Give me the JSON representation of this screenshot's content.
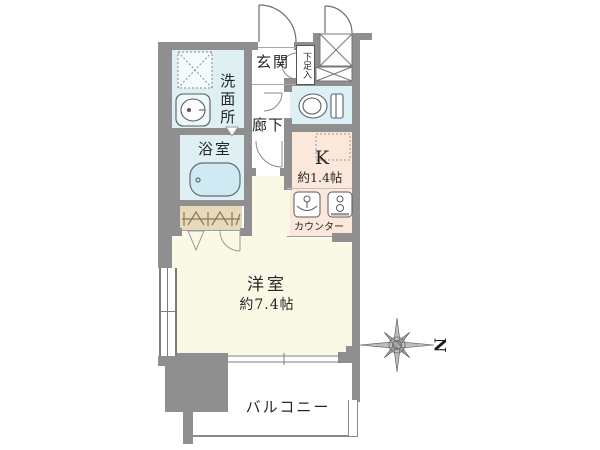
{
  "plan": {
    "rooms": {
      "genkan": {
        "label": "玄関"
      },
      "shoe_storage": {
        "label": "下足入"
      },
      "washroom": {
        "label": "洗面所"
      },
      "bathroom": {
        "label": "浴室"
      },
      "hallway": {
        "label": "廊下"
      },
      "toilet": {
        "label": ""
      },
      "kitchen": {
        "label": "K",
        "size": "約1.4帖",
        "counter_label": "カウンター"
      },
      "western_room": {
        "label": "洋室",
        "size": "約7.4帖"
      },
      "balcony": {
        "label": "バルコニー"
      }
    },
    "compass": {
      "north_label": "N"
    },
    "colors": {
      "wall": "#8f8f8f",
      "water_rooms": "#dff0f5",
      "kitchen": "#fbe8da",
      "western_room": "#faf9e6",
      "closet": "#e7d9bb",
      "background": "#ffffff"
    }
  }
}
